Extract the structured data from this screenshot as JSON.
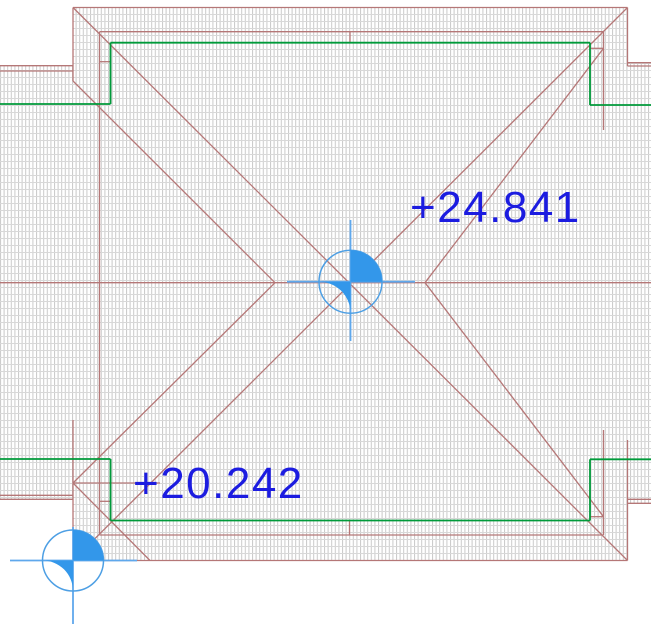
{
  "app": {
    "view_type": "cad-roof-plan-viewport"
  },
  "labels": {
    "upper": "+24.841",
    "lower": "+20.242",
    "upper_pos": {
      "x": 410,
      "y": 186
    },
    "lower_pos": {
      "x": 133,
      "y": 462
    }
  },
  "colors": {
    "background": "#ffffff",
    "line_red": "#b57777",
    "line_green": "#009a3a",
    "label_blue": "#1c1ce0",
    "marker_fill": "#3397ea",
    "marker_stroke": "#4d9fe4",
    "marker_cross": "#5fa8ec",
    "hatch_vertical": "#c9c9c9",
    "hatch_horizontal": "#d8d8d8"
  },
  "drawing": {
    "width": 651,
    "height": 641,
    "hatch_cell": {
      "w": 3.6,
      "h": 7
    },
    "hatch_regions": [
      {
        "name": "main-roof-block",
        "x": 73,
        "y": 7.5,
        "w": 554.5,
        "h": 553
      },
      {
        "name": "left-wing-roof",
        "x": 0,
        "y": 65.7,
        "w": 73,
        "h": 433.6
      },
      {
        "name": "right-wing-roof",
        "x": 627.5,
        "y": 62.7,
        "w": 23.5,
        "h": 440.6
      }
    ],
    "red_lines": [
      [
        73,
        7.5,
        627.5,
        7.5
      ],
      [
        73,
        7.5,
        73,
        81
      ],
      [
        73,
        420,
        73,
        560.5
      ],
      [
        73,
        560.5,
        627.5,
        560.5
      ],
      [
        627.5,
        7.5,
        627.5,
        66
      ],
      [
        627.5,
        440,
        627.5,
        560.5
      ],
      [
        0,
        65.7,
        73,
        65.7
      ],
      [
        0,
        71,
        73,
        71
      ],
      [
        0,
        495.3,
        73,
        495.3
      ],
      [
        0,
        499.3,
        73,
        499.3
      ],
      [
        627.5,
        62.7,
        651,
        62.7
      ],
      [
        627.5,
        66,
        651,
        66
      ],
      [
        627.5,
        499.3,
        651,
        499.3
      ],
      [
        627.5,
        503.3,
        651,
        503.3
      ],
      [
        99.5,
        31.7,
        603.5,
        31.7
      ],
      [
        99.5,
        535,
        603.5,
        535
      ],
      [
        99.5,
        31.7,
        99.5,
        535
      ],
      [
        603.5,
        31.7,
        603.5,
        130
      ],
      [
        603.5,
        430,
        603.5,
        535
      ],
      [
        0,
        282.7,
        651,
        282.7
      ],
      [
        73,
        7.5,
        627.5,
        560.5
      ],
      [
        627.5,
        7.5,
        73,
        560.5
      ],
      [
        73,
        81,
        275,
        282.7
      ],
      [
        73,
        483,
        275,
        282.7
      ],
      [
        603.5,
        48.3,
        425,
        282.7
      ],
      [
        603.5,
        516.7,
        425,
        282.7
      ],
      [
        73,
        483,
        150,
        560.5
      ],
      [
        73,
        483,
        160,
        483
      ],
      [
        350,
        31.7,
        350,
        42.7
      ],
      [
        349.5,
        520.3,
        349.5,
        535
      ],
      [
        99.5,
        61.7,
        110.5,
        61.7
      ],
      [
        99.5,
        501.3,
        110.5,
        501.3
      ],
      [
        590,
        48.3,
        603.5,
        48.3
      ],
      [
        590,
        516.7,
        603.5,
        516.7
      ]
    ],
    "green_lines": [
      [
        0,
        104,
        110.5,
        104
      ],
      [
        110.5,
        104,
        110.5,
        42.7
      ],
      [
        110.5,
        42.7,
        590,
        42.7
      ],
      [
        590,
        42.7,
        590,
        105
      ],
      [
        590,
        105,
        651,
        105
      ],
      [
        0,
        459,
        110.5,
        459
      ],
      [
        110.5,
        459,
        110.5,
        520.5
      ],
      [
        110.5,
        520.5,
        590,
        520.5
      ],
      [
        590,
        520.5,
        590,
        459.3
      ],
      [
        590,
        459.3,
        651,
        459.3
      ]
    ],
    "markers": [
      {
        "name": "spot-elevation-marker-ridge",
        "cx": 350.5,
        "cy": 281.7,
        "r": 31.5,
        "h": [
          287,
          415
        ],
        "v": [
          220,
          341
        ]
      },
      {
        "name": "spot-elevation-marker-corner",
        "cx": 73,
        "cy": 560.5,
        "r": 30.5,
        "h": [
          10,
          137
        ],
        "v": [
          527,
          624
        ]
      }
    ]
  }
}
